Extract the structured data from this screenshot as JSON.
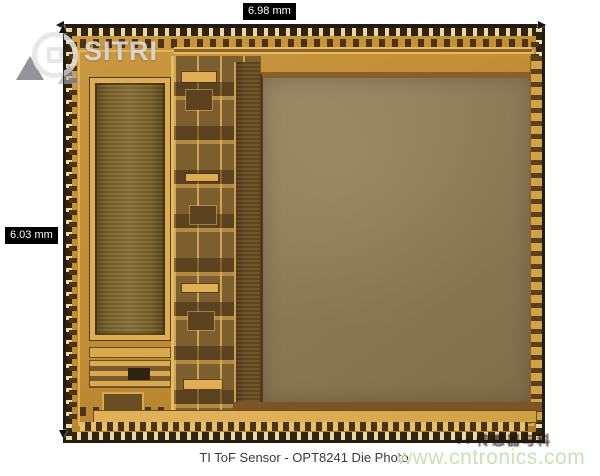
{
  "figure": {
    "caption": "TI ToF Sensor - OPT8241 Die Photo",
    "dimensions": {
      "width_label": "6.98 mm",
      "height_label": "6.03 mm"
    }
  },
  "watermarks": {
    "sitri_text": "SITRI",
    "site_url": "www.cntronics.com",
    "cn_text": "传感器与科"
  },
  "colors": {
    "die_gold": "#c18d34",
    "die_gold_bright": "#e6ba5e",
    "pixel_array_fill": "#8b7954",
    "die_edge_dark": "#241a10",
    "dim_label_bg": "#000000",
    "dim_label_fg": "#ffffff",
    "site_watermark_green": "#c6e3b9",
    "caption_gray": "#3b3b3b"
  }
}
